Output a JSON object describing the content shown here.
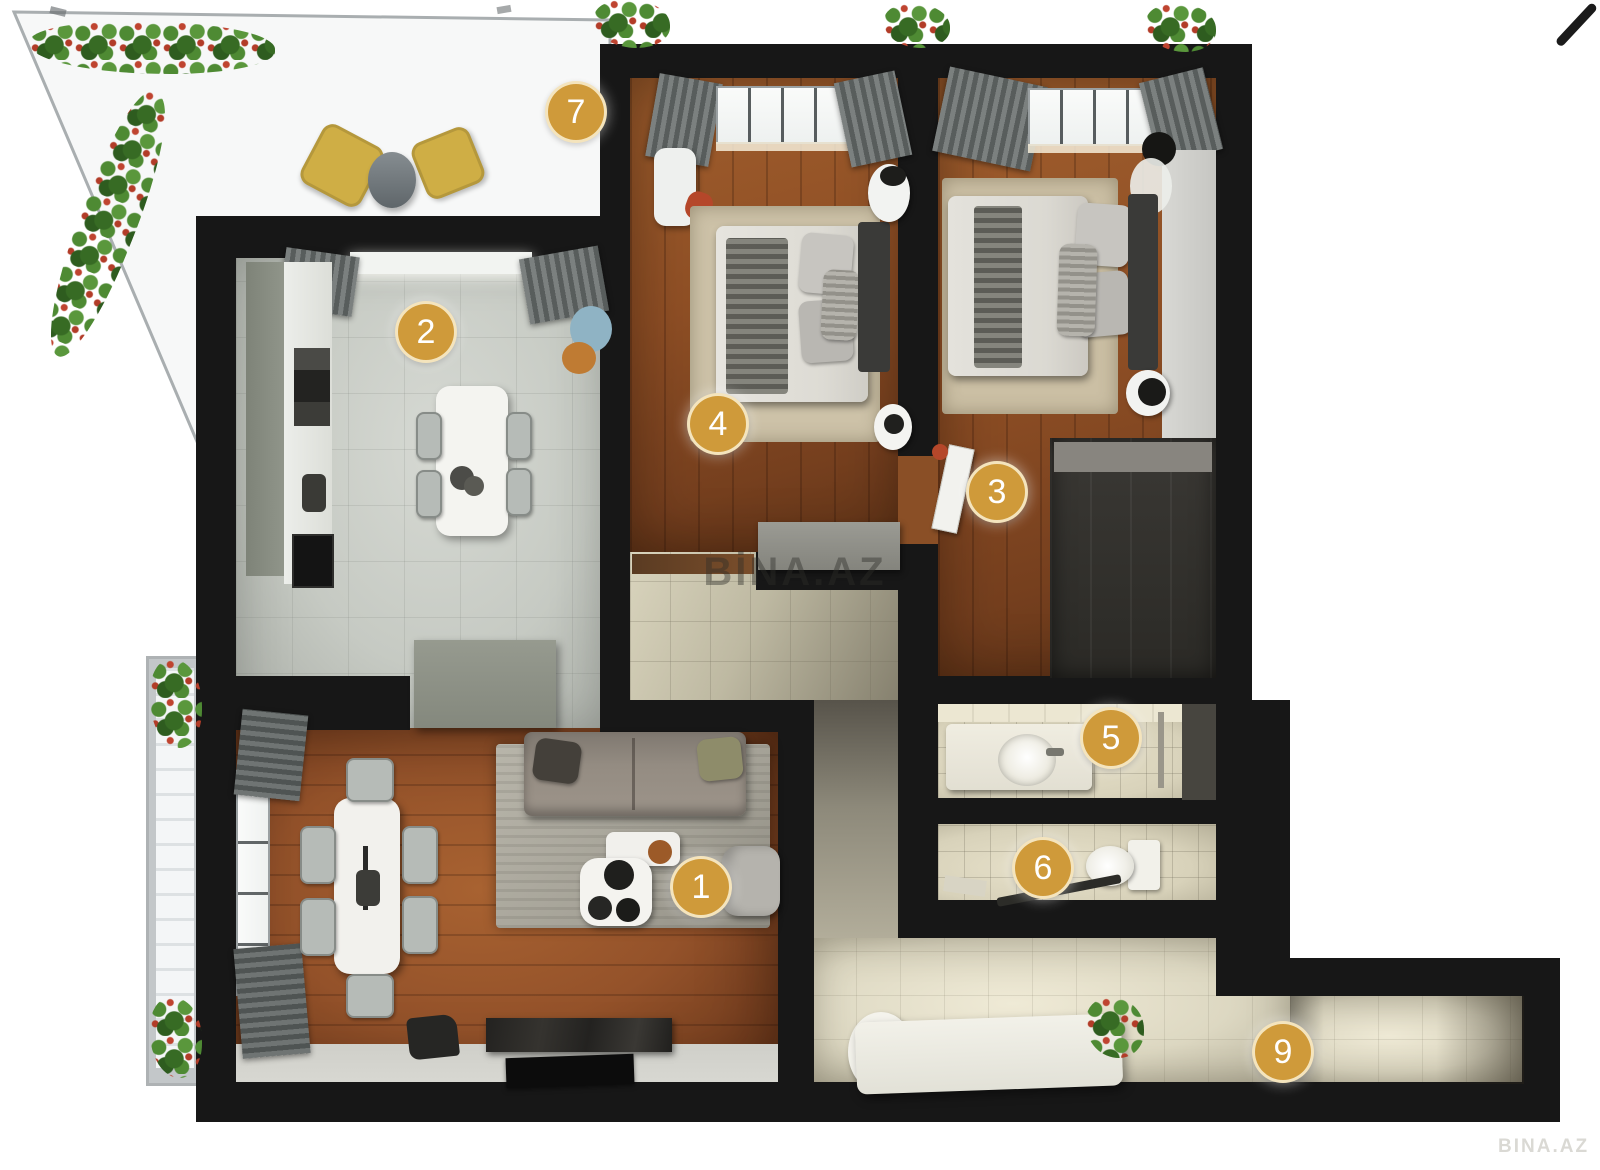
{
  "watermark": {
    "primary": "BİNA.AZ",
    "secondary": "BINA.AZ"
  },
  "badges": [
    {
      "number": "1"
    },
    {
      "number": "2"
    },
    {
      "number": "3"
    },
    {
      "number": "4"
    },
    {
      "number": "5"
    },
    {
      "number": "6"
    },
    {
      "number": "7"
    },
    {
      "number": "9"
    }
  ],
  "colors": {
    "badge_fill": "#CF9A3A",
    "badge_ring": "#F3E3BC",
    "badge_text": "#FFFFFF",
    "wall": "#171717",
    "watermark_text": "#2D2D28"
  }
}
